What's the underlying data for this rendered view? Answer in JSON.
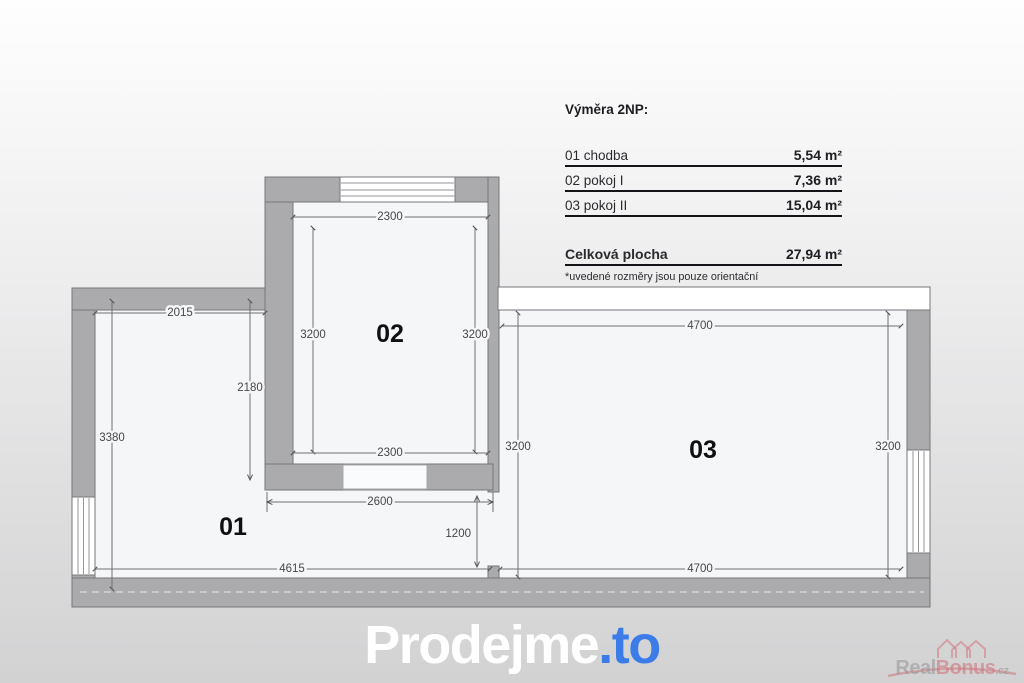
{
  "legend": {
    "title": "Výměra 2NP:",
    "rows": [
      {
        "label": "01 chodba",
        "value": "5,54 m²"
      },
      {
        "label": "02 pokoj I",
        "value": "7,36 m²"
      },
      {
        "label": "03 pokoj II",
        "value": "15,04 m²"
      }
    ],
    "total_label": "Celková plocha",
    "total_value": "27,94 m²",
    "note": "*uvedené rozměry jsou pouze orientační"
  },
  "plan": {
    "rooms": {
      "r01": "01",
      "r02": "02",
      "r03": "03"
    },
    "dims": {
      "r01_top": "2015",
      "r01_left": "3380",
      "r01_inner": "2180",
      "r01_bottom": "4615",
      "r02_top": "2300",
      "r02_left": "3200",
      "r02_right": "3200",
      "r02_bottom": "2300",
      "hall_width": "2600",
      "door_opening": "1200",
      "r03_top": "4700",
      "r03_left": "3200",
      "r03_right": "3200",
      "r03_bottom": "4700"
    }
  },
  "footer": {
    "logo_text": "Prodejme",
    "logo_suffix": ".to"
  },
  "watermark": {
    "part1": "Real",
    "part2": "Bonus",
    "part3": ".cz"
  },
  "colors": {
    "wall": "#ababae",
    "floor": "#f5f6f8",
    "logo_accent": "#3b7ce8",
    "watermark_rose": "#cd767d"
  }
}
